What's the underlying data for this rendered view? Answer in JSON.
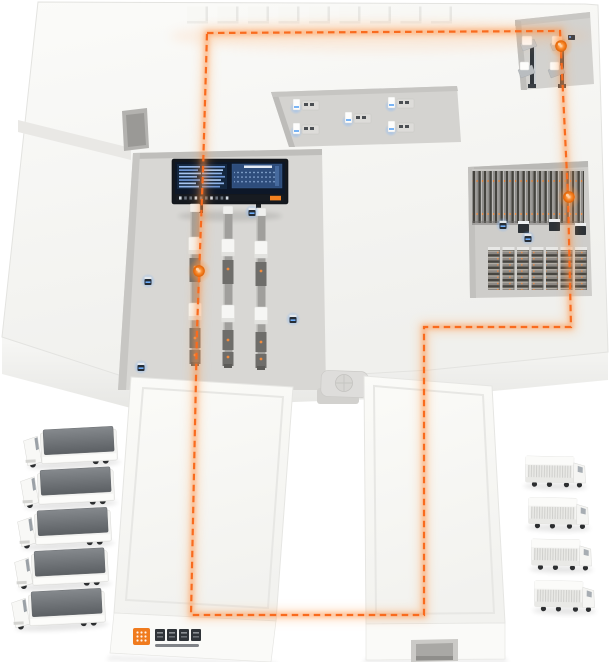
{
  "scene": {
    "kind": "isometric-smart-logistics-park-illustration",
    "background": "#ffffff"
  },
  "colors": {
    "accent_orange": "#f96b1e",
    "glow_orange": "#ff9a4d",
    "marker_core": "#f97316",
    "blue_glow": "#6fb0ff",
    "floor": "#f4f4f1",
    "recess": "#d6d5d2",
    "screen_bezel": "#14181e",
    "screen_field": "#0d1728",
    "screen_panel": "#2e4d7c",
    "trailer_gray": "#6e7276",
    "logo_orange": "#f07b1e"
  },
  "route": {
    "color": "#f96b1e",
    "dash": "6.5 4.5",
    "closed": true,
    "points": [
      [
        207,
        33
      ],
      [
        560,
        31
      ],
      [
        568,
        196
      ],
      [
        571,
        327
      ],
      [
        424,
        327
      ],
      [
        424,
        615
      ],
      [
        191,
        615
      ],
      [
        197,
        330
      ],
      [
        203,
        170
      ]
    ]
  },
  "markers": [
    {
      "name": "route-marker-machining-bay",
      "x": 561,
      "y": 46
    },
    {
      "name": "route-marker-storage-bay",
      "x": 569,
      "y": 197
    },
    {
      "name": "route-marker-production-line",
      "x": 199,
      "y": 271
    }
  ],
  "sensors": [
    {
      "x": 148,
      "y": 281
    },
    {
      "x": 293,
      "y": 319
    },
    {
      "x": 141,
      "y": 367
    },
    {
      "x": 252,
      "y": 212
    },
    {
      "x": 503,
      "y": 225
    },
    {
      "x": 528,
      "y": 238
    }
  ],
  "roof_bumps": {
    "count": 9,
    "x0": 187,
    "step": 30.5,
    "y": 6.5,
    "w": 21,
    "h": 17
  },
  "conveyors": {
    "xs": [
      195,
      228,
      261
    ],
    "y_offsets": [
      0,
      2,
      4
    ],
    "cap_y": 204,
    "belt_y": 212,
    "belt_h": 152
  },
  "workstations": [
    {
      "x": 293,
      "y": 99
    },
    {
      "x": 293,
      "y": 123
    },
    {
      "x": 345,
      "y": 112
    },
    {
      "x": 388,
      "y": 97
    },
    {
      "x": 388,
      "y": 121
    }
  ],
  "rack_wall": {
    "x": 472,
    "y": 171,
    "w": 112,
    "h": 52
  },
  "rack_towers": {
    "count": 7,
    "x0": 488,
    "step": 14.5,
    "y": 250,
    "w": 12,
    "h": 40
  },
  "agv_carts": [
    {
      "x": 518,
      "y": 224
    },
    {
      "x": 549,
      "y": 222
    },
    {
      "x": 575,
      "y": 226
    }
  ],
  "machine_stations": {
    "xs": [
      522,
      552
    ],
    "y": 36
  },
  "dashboard": {
    "x": 172,
    "y": 159,
    "w": 116,
    "h": 45,
    "left_rows": 7,
    "ticker_ticks": 10
  },
  "trucks_left": {
    "count": 5,
    "x0": 22,
    "y0": 430,
    "step": 40.5,
    "x_drift": -3,
    "angle": -3
  },
  "trucks_right": {
    "count": 4,
    "x0": 526,
    "y0": 453,
    "step": 41.5,
    "x_drift": 3,
    "angle": 1
  },
  "logo": {
    "tile_color": "#f07b1e",
    "text_blocks": 4,
    "x": 133,
    "y": 628
  }
}
